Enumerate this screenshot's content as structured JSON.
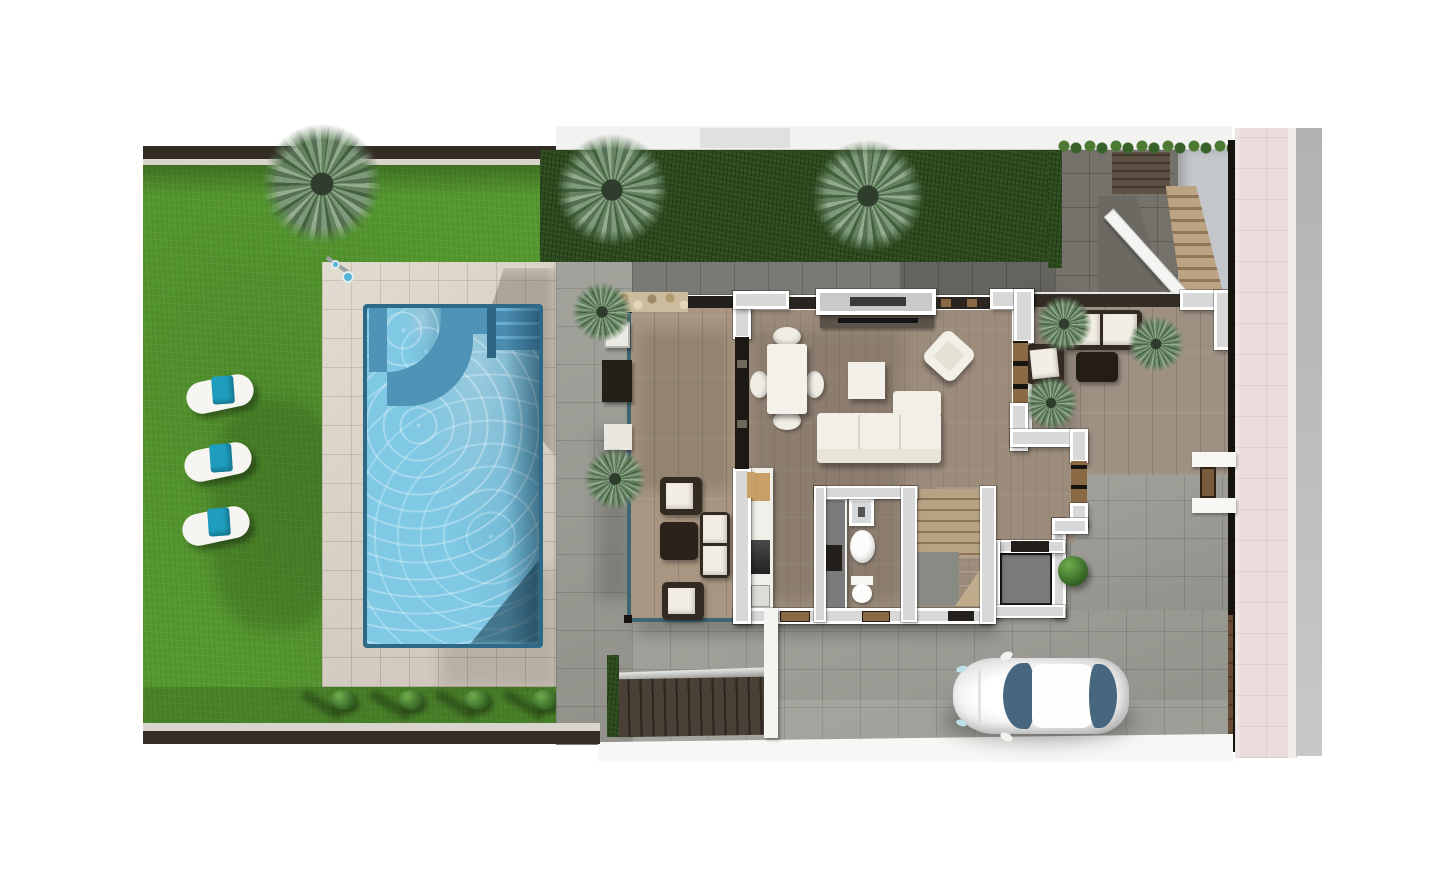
{
  "scene": {
    "kind": "architectural-floor-plan-render",
    "view": "top-down",
    "storey": "ground-floor-with-garden"
  },
  "palette": {
    "lawn": "#55982f",
    "hedge": "#2c4a1e",
    "deck": "#d8d0c2",
    "concrete": "#9c9c95",
    "concreteDark": "#74726b",
    "woodFloor": "#9c8c7c",
    "woodTerrace": "#a89682",
    "woodPatio": "#9e9184",
    "water": "#7fc9e5",
    "waterBench": "#4f93b6",
    "poolRim": "#2e6a88",
    "wallFill": "#d8d8d8",
    "wallWhite": "#ffffff",
    "doorBrown": "#8a6a44",
    "stone": "#cdbb9d",
    "darkWall": "#332c24",
    "boundary": "#17130f",
    "gateBrown": "#6a4c34",
    "pinkWalk": "#e9dcdb",
    "road": "#b8b8b8",
    "towel": "#1f9dbe",
    "carGlass": "#47677e",
    "cushion": "#f2eee4",
    "frameDark": "#332a21",
    "grayFloor": "#7b7b7b",
    "stairWood": "#b29878"
  },
  "regions": {
    "garden": "lawn with sun loungers",
    "pool": "rectangular pool with curved bench and steps",
    "poolDeck": "beige tiled deck with outdoor shower",
    "terrace": "covered wood terrace with lounge set",
    "livingRoom": "open living / dining room",
    "kitchen": "linear kitchen with island unit",
    "bathroom": "shower room with basin and wc",
    "stairs": "interior staircase with landing",
    "utility": "utility room with dark floor",
    "eastPatio": "wood-plank patio with rattan lounge set",
    "entryCourt": "rear courtyard with exterior stair",
    "driveway": "concrete parking court with car",
    "sidewalk": "pink paved public sidewalk and road strip"
  },
  "objects": {
    "sun_loungers": 3,
    "lounger_towel_color": "#1f9dbe",
    "palm_trees": 8,
    "bushes": 5,
    "car": {
      "count": 1,
      "body": "white",
      "glass": "#47677e",
      "facing": "left"
    },
    "dining_seats": 4,
    "sofa_seats": 3,
    "terrace_armchairs": 2,
    "patio_sofa_cushions": 2
  }
}
